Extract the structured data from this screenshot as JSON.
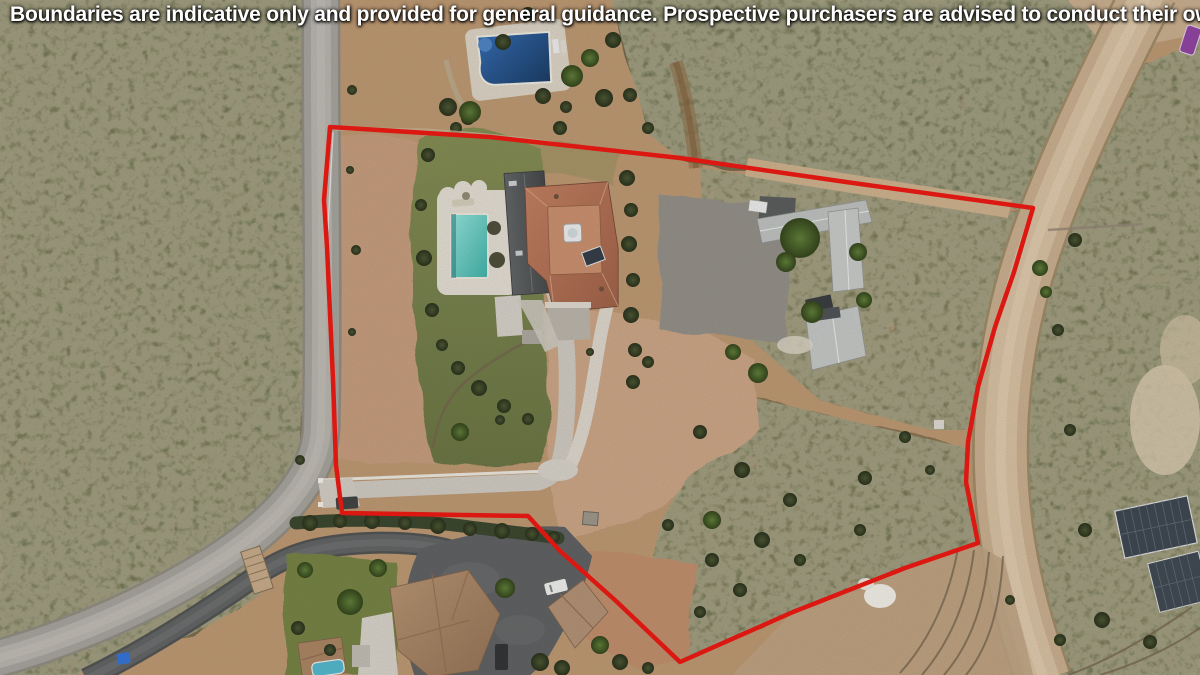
{
  "banner": {
    "text": "Boundaries are indicative only and provided for general guidance. Prospective purchasers are advised to conduct their own due diligence."
  },
  "boundary": {
    "color": "#e8130e",
    "stroke_width": 4.5,
    "points": "330,127 490,137 680,158 846,182 1033,208 1014,272 995,327 978,387 968,442 966,482 978,543 905,568 793,612 680,662 616,601 560,551 528,516 342,513 336,465 333,380 327,247 324,200 330,127"
  },
  "palette": {
    "boundary_red": "#e8130e",
    "banner_text": "#ffffff",
    "scrub_olive": "#70664a",
    "dirt_tan": "#c49e80",
    "road_gray": "#a5a3a0",
    "dirt_road_tan": "#c9af90",
    "asphalt_gray": "#5a5c5e",
    "concrete_light": "#cdc9c1",
    "lawn_green": "#76814a",
    "pool_turquoise": "#62cbc4",
    "neighbor_pool_navy": "#1f4e86",
    "villa_roof_terracotta": "#b3755a",
    "villa_roof_gray": "#4e5154",
    "outbuilding_roof_gray": "#c0c4c3",
    "solar_panel_dark": "#3a434e"
  }
}
